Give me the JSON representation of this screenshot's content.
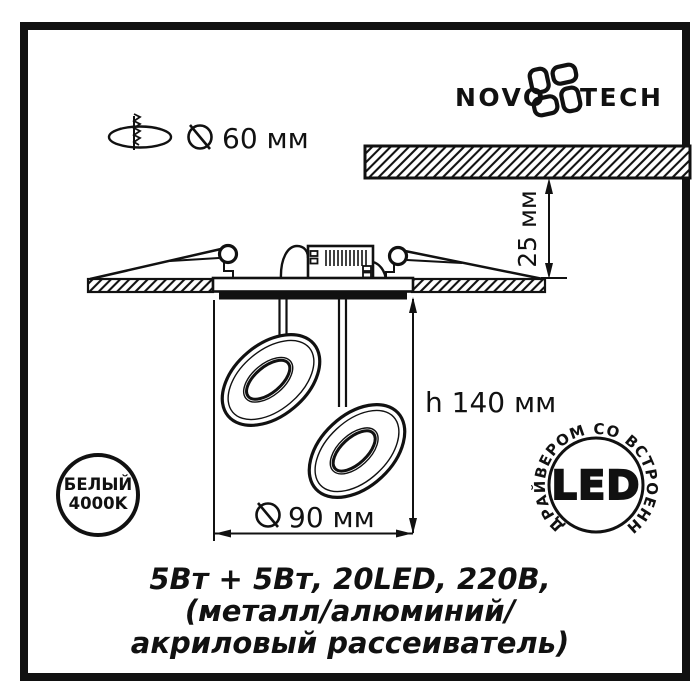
{
  "header": {
    "hole_diameter_label": "60 мм",
    "brand_left": "NOVO",
    "brand_right": "TECH"
  },
  "diagram": {
    "recess_depth_label": "25 мм",
    "height_label": "h 140 мм",
    "diameter_label": "90 мм"
  },
  "badges": {
    "color_temp": {
      "line1": "БЕЛЫЙ",
      "line2": "4000K"
    },
    "led": {
      "center": "LED",
      "ring_text": "ДРАЙВЕРОМ СО ВСТРОЕННЫМ"
    }
  },
  "specs": {
    "line1": "5Вт + 5Вт, 20LED, 220В,",
    "line2": "(металл/алюминий/",
    "line3": "акриловый рассеиватель)"
  },
  "colors": {
    "ink": "#111111",
    "background": "#ffffff"
  }
}
